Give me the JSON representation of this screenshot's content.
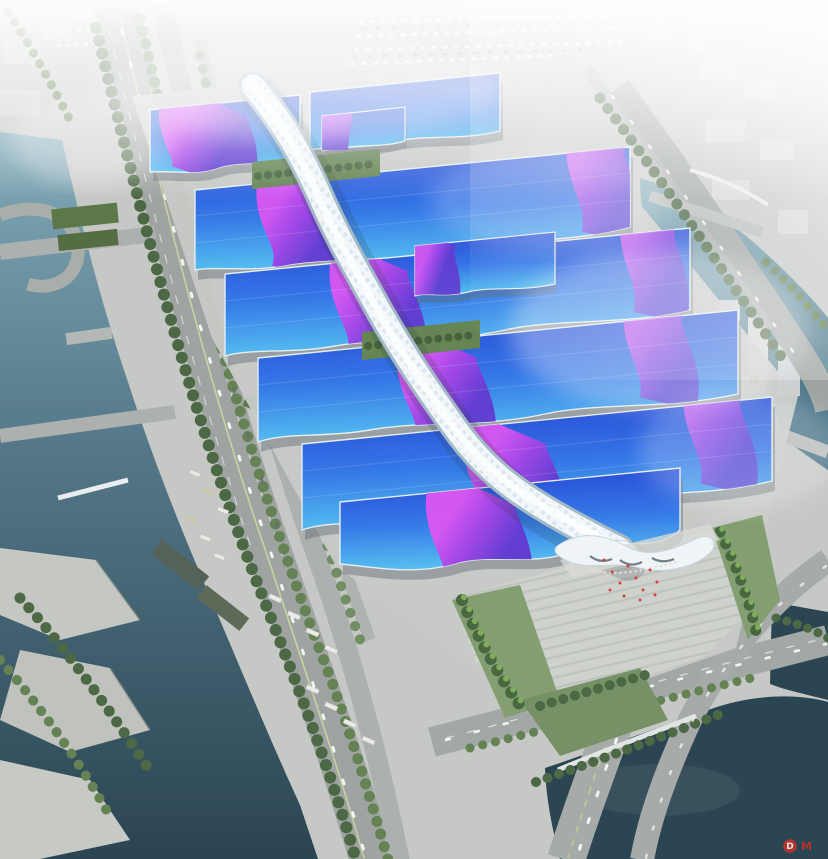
{
  "watermark": {
    "logo_letter": "D",
    "text": "M"
  },
  "palette": {
    "roof_deep": "#1b3bd2",
    "roof_mid": "#2b72e6",
    "roof_cyan": "#4fc0f0",
    "ribbon_magenta": "#d84df2",
    "ribbon_mid": "#9a3ae4",
    "ribbon_violet": "#5a30ce",
    "spine_light": "#f1f7fa",
    "spine_shade": "#9fb6c4",
    "river_teal": "#7ba6b5",
    "river_deep": "#416e82",
    "pond_dark": "#203b49",
    "ground": "#c6c8c5",
    "road": "#9aa09d",
    "tree_dark": "#43603a",
    "tree_mid": "#5c7c4a",
    "palm_green": "#79a855",
    "lawn": "#7d9a6b",
    "city_block": "#d3d6d5",
    "flag_red": "#d23a2e",
    "watermark_red": "#cc3227"
  }
}
